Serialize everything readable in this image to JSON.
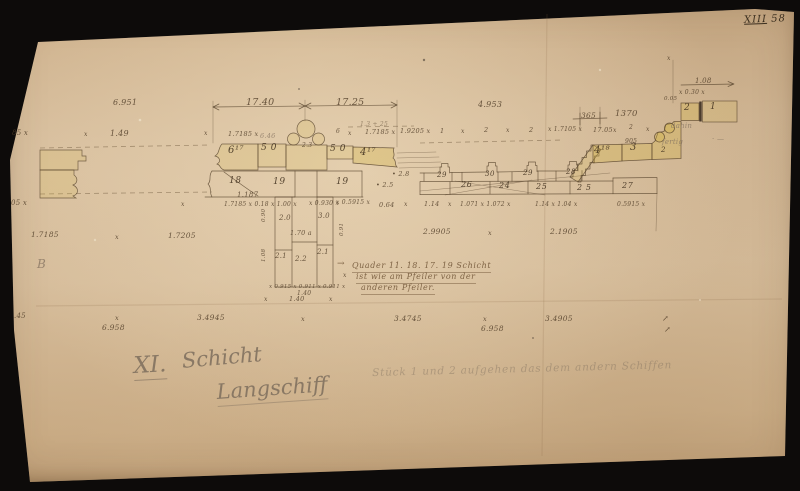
{
  "corner": {
    "roman": "XIII",
    "number": "58"
  },
  "titles": {
    "course": "XI.",
    "course_word": "Schicht",
    "location": "Langschiff",
    "pencil_note": "Stück 1 und 2 aufgehen das dem andern Schiffen"
  },
  "center_note": {
    "arrow": "→",
    "line1": "Quader 11. 18. 17. 19 Schicht",
    "line2": "ist wie am Pfeiler von der",
    "line3": "anderen Pfeiler."
  },
  "colors": {
    "background": "#0d0b0a",
    "paper": "#d8bf9e",
    "ink": "#4e3b26",
    "pencil": "#887663",
    "wash": "#d2b545"
  },
  "annotations": [
    {
      "t": "6.951",
      "x": 113,
      "y": 99,
      "s": 8
    },
    {
      "t": "x",
      "x": 84,
      "y": 132,
      "s": 6
    },
    {
      "t": "1.49",
      "x": 110,
      "y": 130,
      "s": 8
    },
    {
      "t": "85 x",
      "x": 12,
      "y": 130,
      "s": 7
    },
    {
      "t": "17.40",
      "x": 246,
      "y": 98,
      "s": 9.5
    },
    {
      "t": "17.25",
      "x": 336,
      "y": 98,
      "s": 9.5
    },
    {
      "t": "4.953",
      "x": 478,
      "y": 101,
      "s": 8
    },
    {
      "t": "365",
      "x": 581,
      "y": 112,
      "s": 7.5
    },
    {
      "t": "1370",
      "x": 615,
      "y": 110,
      "s": 8.5
    },
    {
      "t": "x",
      "x": 667,
      "y": 56,
      "s": 6
    },
    {
      "t": "1.08",
      "x": 695,
      "y": 78,
      "s": 7
    },
    {
      "t": "x 0.30 x",
      "x": 679,
      "y": 90,
      "s": 6
    },
    {
      "t": "0.05",
      "x": 664,
      "y": 97,
      "s": 5.5
    },
    {
      "t": "x",
      "x": 204,
      "y": 131,
      "s": 6
    },
    {
      "t": "1.7185 x",
      "x": 228,
      "y": 131,
      "s": 6.5
    },
    {
      "t": "6.46",
      "x": 260,
      "y": 133,
      "s": 6.5,
      "c": "p"
    },
    {
      "t": "6",
      "x": 336,
      "y": 129,
      "s": 6
    },
    {
      "t": "x",
      "x": 348,
      "y": 131,
      "s": 6
    },
    {
      "t": "1.7185 x",
      "x": 365,
      "y": 129,
      "s": 6.5
    },
    {
      "t": "1.9205 x",
      "x": 400,
      "y": 128,
      "s": 6.5
    },
    {
      "t": "1.3 + 25",
      "x": 360,
      "y": 122,
      "s": 6,
      "c": "if"
    },
    {
      "t": "1",
      "x": 440,
      "y": 128,
      "s": 6.5
    },
    {
      "t": "x",
      "x": 461,
      "y": 129,
      "s": 6
    },
    {
      "t": "2",
      "x": 484,
      "y": 127,
      "s": 6.5
    },
    {
      "t": "x",
      "x": 506,
      "y": 128,
      "s": 6
    },
    {
      "t": "2",
      "x": 529,
      "y": 127,
      "s": 6.5
    },
    {
      "t": "x 1.7105 x",
      "x": 548,
      "y": 127,
      "s": 6
    },
    {
      "t": "17.05",
      "x": 593,
      "y": 127,
      "s": 6.5
    },
    {
      "t": "x",
      "x": 613,
      "y": 128,
      "s": 6
    },
    {
      "t": "2",
      "x": 629,
      "y": 125,
      "s": 6
    },
    {
      "t": "905",
      "x": 625,
      "y": 139,
      "s": 6
    },
    {
      "t": "x",
      "x": 646,
      "y": 127,
      "s": 6
    },
    {
      "t": "dahin",
      "x": 671,
      "y": 123,
      "s": 7,
      "c": "p"
    },
    {
      "t": "fertig",
      "x": 662,
      "y": 139,
      "s": 7,
      "c": "p"
    },
    {
      "t": "· —",
      "x": 712,
      "y": 136,
      "s": 7,
      "c": "p"
    },
    {
      "t": "6¹⁷",
      "x": 228,
      "y": 146,
      "s": 10,
      "c": "ib"
    },
    {
      "t": "5 0",
      "x": 261,
      "y": 144,
      "s": 9,
      "c": "ib"
    },
    {
      "t": "2.3",
      "x": 302,
      "y": 143,
      "s": 6
    },
    {
      "t": "5 0",
      "x": 330,
      "y": 145,
      "s": 9,
      "c": "ib"
    },
    {
      "t": "4¹⁷",
      "x": 360,
      "y": 148,
      "s": 10,
      "c": "ib"
    },
    {
      "t": "18",
      "x": 229,
      "y": 177,
      "s": 9,
      "c": "ib"
    },
    {
      "t": "1.187",
      "x": 237,
      "y": 192,
      "s": 7
    },
    {
      "t": "19",
      "x": 273,
      "y": 178,
      "s": 9,
      "c": "ib"
    },
    {
      "t": "19",
      "x": 336,
      "y": 178,
      "s": 9,
      "c": "ib"
    },
    {
      "t": "29",
      "x": 437,
      "y": 172,
      "s": 7,
      "c": "ib"
    },
    {
      "t": "30",
      "x": 485,
      "y": 171,
      "s": 7,
      "c": "ib"
    },
    {
      "t": "29",
      "x": 523,
      "y": 170,
      "s": 7,
      "c": "ib"
    },
    {
      "t": "28",
      "x": 566,
      "y": 169,
      "s": 7,
      "c": "ib"
    },
    {
      "t": "• 2.8",
      "x": 392,
      "y": 171,
      "s": 6.5
    },
    {
      "t": "• 2.5",
      "x": 376,
      "y": 182,
      "s": 6.5
    },
    {
      "t": "26",
      "x": 461,
      "y": 181,
      "s": 8,
      "c": "ib"
    },
    {
      "t": "24",
      "x": 499,
      "y": 182,
      "s": 8,
      "c": "ib"
    },
    {
      "t": "25",
      "x": 536,
      "y": 183,
      "s": 8,
      "c": "ib"
    },
    {
      "t": "2 5",
      "x": 577,
      "y": 184,
      "s": 8,
      "c": "ib"
    },
    {
      "t": "27",
      "x": 622,
      "y": 182,
      "s": 8,
      "c": "ib"
    },
    {
      "t": "4¹⁸",
      "x": 594,
      "y": 146,
      "s": 10,
      "c": "ib"
    },
    {
      "t": "3",
      "x": 630,
      "y": 143,
      "s": 10,
      "c": "ib"
    },
    {
      "t": "2",
      "x": 661,
      "y": 147,
      "s": 7,
      "c": "ib"
    },
    {
      "t": "2",
      "x": 684,
      "y": 104,
      "s": 9,
      "c": "ib"
    },
    {
      "t": "1",
      "x": 710,
      "y": 103,
      "s": 9,
      "c": "ib"
    },
    {
      "t": "2.0",
      "x": 279,
      "y": 215,
      "s": 7
    },
    {
      "t": "3.0",
      "x": 318,
      "y": 213,
      "s": 7
    },
    {
      "t": "1.70 a",
      "x": 290,
      "y": 230,
      "s": 6.5
    },
    {
      "t": "2.1",
      "x": 275,
      "y": 253,
      "s": 7
    },
    {
      "t": "2.2",
      "x": 295,
      "y": 256,
      "s": 7
    },
    {
      "t": "2.1",
      "x": 317,
      "y": 249,
      "s": 7
    },
    {
      "t": "0.90",
      "x": 262,
      "y": 222,
      "s": 5.5,
      "r": -90
    },
    {
      "t": "1.08",
      "x": 262,
      "y": 262,
      "s": 5.5,
      "r": -90
    },
    {
      "t": "0.91",
      "x": 340,
      "y": 236,
      "s": 5.5,
      "r": -90
    },
    {
      "t": "x 0.915 x 0.911 x 0.911 x",
      "x": 269,
      "y": 285,
      "s": 5.5
    },
    {
      "t": "1.40",
      "x": 297,
      "y": 291,
      "s": 6
    },
    {
      "t": "x",
      "x": 181,
      "y": 202,
      "s": 6
    },
    {
      "t": "1.7185 x 0.18 x 1.00 x",
      "x": 224,
      "y": 202,
      "s": 6
    },
    {
      "t": "x 0.930 x",
      "x": 309,
      "y": 201,
      "s": 6
    },
    {
      "t": "x 0.5915 x",
      "x": 336,
      "y": 200,
      "s": 6
    },
    {
      "t": "0.64",
      "x": 379,
      "y": 202,
      "s": 6.5
    },
    {
      "t": "x",
      "x": 404,
      "y": 202,
      "s": 6
    },
    {
      "t": "1.14",
      "x": 424,
      "y": 201,
      "s": 6.5
    },
    {
      "t": "x",
      "x": 448,
      "y": 202,
      "s": 6
    },
    {
      "t": "1.071 x 1.072 x",
      "x": 460,
      "y": 202,
      "s": 6
    },
    {
      "t": "1.14 x 1.04 x",
      "x": 535,
      "y": 202,
      "s": 6
    },
    {
      "t": "0.5915 x",
      "x": 617,
      "y": 202,
      "s": 6
    },
    {
      "t": "05 x",
      "x": 11,
      "y": 200,
      "s": 7
    },
    {
      "t": "1.7185",
      "x": 31,
      "y": 231,
      "s": 7.5
    },
    {
      "t": "x",
      "x": 115,
      "y": 234,
      "s": 6.5
    },
    {
      "t": "1.7205",
      "x": 168,
      "y": 232,
      "s": 7.5
    },
    {
      "t": "2.9905",
      "x": 423,
      "y": 228,
      "s": 7.5
    },
    {
      "t": "x",
      "x": 488,
      "y": 230,
      "s": 6.5
    },
    {
      "t": "2.1905",
      "x": 550,
      "y": 228,
      "s": 7.5
    },
    {
      "t": "x",
      "x": 343,
      "y": 273,
      "s": 6
    },
    {
      "t": "B",
      "x": 37,
      "y": 258,
      "s": 12,
      "c": "p"
    },
    {
      "t": "x",
      "x": 264,
      "y": 297,
      "s": 6
    },
    {
      "t": "1.40",
      "x": 289,
      "y": 296,
      "s": 6.5
    },
    {
      "t": "x",
      "x": 329,
      "y": 297,
      "s": 6
    },
    {
      "t": ".45",
      "x": 14,
      "y": 313,
      "s": 7
    },
    {
      "t": "x",
      "x": 115,
      "y": 315,
      "s": 6.5
    },
    {
      "t": "3.4945",
      "x": 197,
      "y": 314,
      "s": 7.5
    },
    {
      "t": "x",
      "x": 301,
      "y": 316,
      "s": 6.5
    },
    {
      "t": "3.4745",
      "x": 394,
      "y": 315,
      "s": 7.5
    },
    {
      "t": "x",
      "x": 483,
      "y": 316,
      "s": 6.5
    },
    {
      "t": "3.4905",
      "x": 545,
      "y": 315,
      "s": 7.5
    },
    {
      "t": "6.958",
      "x": 102,
      "y": 324,
      "s": 7.5
    },
    {
      "t": "6.958",
      "x": 481,
      "y": 325,
      "s": 7.5
    },
    {
      "t": "↗",
      "x": 662,
      "y": 315,
      "s": 8
    },
    {
      "t": "↗",
      "x": 664,
      "y": 326,
      "s": 8
    }
  ]
}
